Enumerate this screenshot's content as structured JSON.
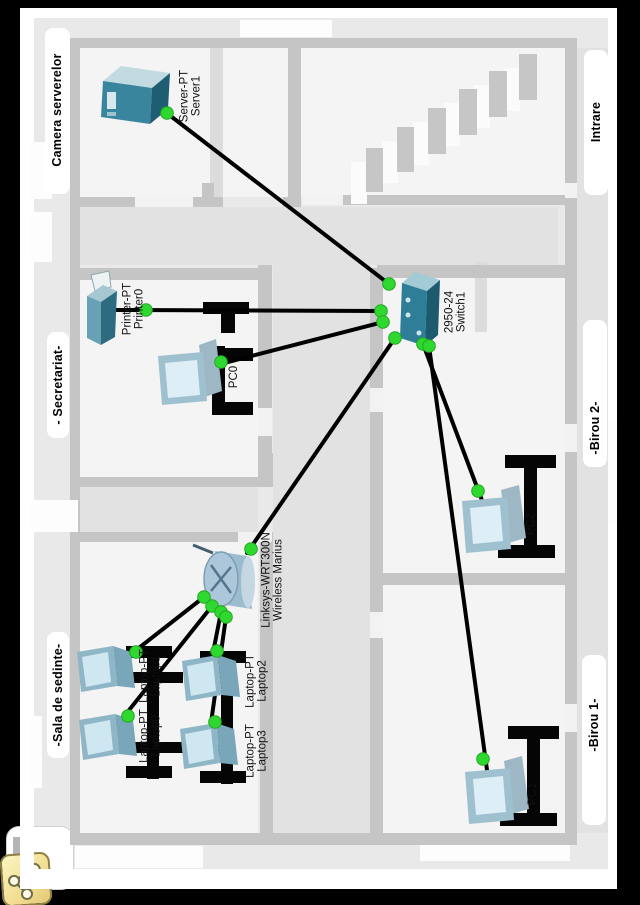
{
  "rooms": [
    {
      "id": "camera-serverelor",
      "label": "Camera serverelor"
    },
    {
      "id": "secretariat",
      "label": "- Secretariat-"
    },
    {
      "id": "sala-de-sedinte",
      "label": "-Sala de sedinte-"
    },
    {
      "id": "intrare",
      "label": "Intrare"
    },
    {
      "id": "birou2",
      "label": "-Birou 2-"
    },
    {
      "id": "birou1",
      "label": "-Birou 1-"
    }
  ],
  "devices": [
    {
      "id": "server1",
      "type": "server",
      "label_lines": [
        "Server-PT",
        "Server1"
      ]
    },
    {
      "id": "printer0",
      "type": "printer",
      "label_lines": [
        "Printer-PT",
        "Printer0"
      ]
    },
    {
      "id": "pc0",
      "type": "pc",
      "label_lines": [
        "PC0"
      ]
    },
    {
      "id": "switch1",
      "type": "switch",
      "label_lines": [
        "2950-24",
        "Switch1"
      ]
    },
    {
      "id": "wireless",
      "type": "wireless-router",
      "label_lines": [
        "Linksys-WRT300N",
        "Wireless Marius"
      ]
    },
    {
      "id": "pc2",
      "type": "pc",
      "label_lines": [
        "PC2"
      ]
    },
    {
      "id": "pc1",
      "type": "pc",
      "label_lines": [
        "PC1"
      ]
    },
    {
      "id": "laptop0",
      "type": "laptop",
      "label_lines": [
        "Laptop-PT",
        "Laptop0"
      ]
    },
    {
      "id": "laptop1",
      "type": "laptop",
      "label_lines": [
        "Laptop-PT",
        "Laptop1"
      ]
    },
    {
      "id": "laptop2",
      "type": "laptop",
      "label_lines": [
        "Laptop-PT",
        "Laptop2"
      ]
    },
    {
      "id": "laptop3",
      "type": "laptop",
      "label_lines": [
        "Laptop-PT",
        "Laptop3"
      ]
    }
  ],
  "links": [
    {
      "from": "server1",
      "to": "switch1",
      "status": "up"
    },
    {
      "from": "printer0",
      "to": "switch1",
      "status": "up"
    },
    {
      "from": "pc0",
      "to": "switch1",
      "status": "up"
    },
    {
      "from": "wireless",
      "to": "switch1",
      "status": "up"
    },
    {
      "from": "pc2",
      "to": "switch1",
      "status": "up"
    },
    {
      "from": "pc1",
      "to": "switch1",
      "status": "up"
    },
    {
      "from": "laptop0",
      "to": "wireless",
      "status": "up"
    },
    {
      "from": "laptop1",
      "to": "wireless",
      "status": "up"
    },
    {
      "from": "laptop2",
      "to": "wireless",
      "status": "up"
    },
    {
      "from": "laptop3",
      "to": "wireless",
      "status": "up"
    }
  ],
  "back_button": {
    "icon": "network-cluster-icon"
  },
  "colors": {
    "canvas": "#e9e9e9",
    "room": "#f4f4f4",
    "hall": "#e2e2e2",
    "wall": "#c5c5c5",
    "cable": "#000000",
    "link_up_dot": "#2fd82f",
    "device_teal": "#3a859e",
    "laptop_screen": "#cfe7f1",
    "back_icon_yellow": "#f2df93"
  }
}
